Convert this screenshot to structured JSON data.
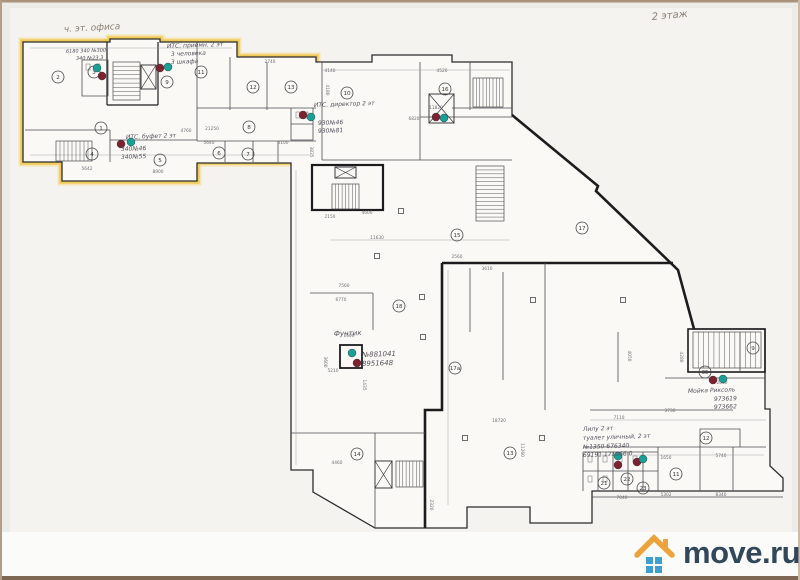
{
  "photo": {
    "type": "scanned floor plan photo",
    "floor_note_top_left": "ч. эт. офиса",
    "floor_note_top_right": "2 этаж"
  },
  "brand": {
    "name": "move.ru",
    "colors": {
      "roof": "#eda33c",
      "windows": "#3f9ed0",
      "text": "#33475b"
    }
  },
  "plan": {
    "highlight_color": "#f0c339",
    "marker_colors": {
      "teal": "#17a093",
      "red": "#7e2130"
    },
    "annotations": [
      {
        "text": "ч. эт. офиса",
        "x": 64,
        "y": 32,
        "size": 9,
        "rot": -3,
        "kind": "pencil"
      },
      {
        "text": "2 этаж",
        "x": 652,
        "y": 20,
        "size": 10,
        "rot": -5,
        "kind": "pencil"
      },
      {
        "text": "6180 340 №300",
        "x": 66,
        "y": 53,
        "size": 5
      },
      {
        "text": "340 №23.3",
        "x": 76,
        "y": 60,
        "size": 5
      },
      {
        "text": "ИТС. приёмн. 2 эт",
        "x": 167,
        "y": 48,
        "size": 6
      },
      {
        "text": "3 человека",
        "x": 171,
        "y": 56,
        "size": 6
      },
      {
        "text": "3 шкафа",
        "x": 171,
        "y": 64,
        "size": 6
      },
      {
        "text": "ИТС. директор 2 эт",
        "x": 314,
        "y": 107,
        "size": 6
      },
      {
        "text": "930№46",
        "x": 318,
        "y": 125,
        "size": 6
      },
      {
        "text": "930№81",
        "x": 318,
        "y": 133,
        "size": 6
      },
      {
        "text": "ИТС. буфет 2 эт",
        "x": 126,
        "y": 139,
        "size": 6
      },
      {
        "text": "340№46",
        "x": 121,
        "y": 151,
        "size": 6
      },
      {
        "text": "340№55",
        "x": 121,
        "y": 159,
        "size": 6
      },
      {
        "text": "Фунтик",
        "x": 334,
        "y": 336,
        "size": 7
      },
      {
        "text": "№881041",
        "x": 362,
        "y": 357,
        "size": 7
      },
      {
        "text": "8951648",
        "x": 362,
        "y": 366,
        "size": 7
      },
      {
        "text": "Мойка Риксоль",
        "x": 688,
        "y": 393,
        "size": 6
      },
      {
        "text": "973619",
        "x": 714,
        "y": 401,
        "size": 6
      },
      {
        "text": "973662",
        "x": 714,
        "y": 409,
        "size": 6
      },
      {
        "text": "Лилу 2 эт",
        "x": 583,
        "y": 431,
        "size": 6
      },
      {
        "text": "туалет уличный, 2 эт",
        "x": 583,
        "y": 440,
        "size": 6
      },
      {
        "text": "№1350  676340",
        "x": 583,
        "y": 449,
        "size": 6
      },
      {
        "text": "69191  171066 0",
        "x": 583,
        "y": 457,
        "size": 6
      }
    ],
    "rooms": [
      {
        "n": "2",
        "x": 58,
        "y": 77
      },
      {
        "n": "3",
        "x": 94,
        "y": 72
      },
      {
        "n": "9",
        "x": 167,
        "y": 82
      },
      {
        "n": "1",
        "x": 101,
        "y": 128
      },
      {
        "n": "11",
        "x": 201,
        "y": 72
      },
      {
        "n": "12",
        "x": 253,
        "y": 87
      },
      {
        "n": "13",
        "x": 291,
        "y": 87
      },
      {
        "n": "8",
        "x": 249,
        "y": 127
      },
      {
        "n": "4",
        "x": 92,
        "y": 154
      },
      {
        "n": "5",
        "x": 160,
        "y": 160
      },
      {
        "n": "6",
        "x": 219,
        "y": 153
      },
      {
        "n": "7",
        "x": 248,
        "y": 154
      },
      {
        "n": "10",
        "x": 347,
        "y": 93
      },
      {
        "n": "16",
        "x": 445,
        "y": 89
      },
      {
        "n": "15",
        "x": 457,
        "y": 235
      },
      {
        "n": "17",
        "x": 582,
        "y": 228
      },
      {
        "n": "18",
        "x": 399,
        "y": 306
      },
      {
        "n": "17а",
        "x": 455,
        "y": 368
      },
      {
        "n": "14",
        "x": 357,
        "y": 454
      },
      {
        "n": "13",
        "x": 510,
        "y": 453
      },
      {
        "n": "9",
        "x": 753,
        "y": 348
      },
      {
        "n": "35",
        "x": 705,
        "y": 372
      },
      {
        "n": "12",
        "x": 706,
        "y": 438
      },
      {
        "n": "11",
        "x": 676,
        "y": 474
      },
      {
        "n": "21",
        "x": 604,
        "y": 483
      },
      {
        "n": "22",
        "x": 627,
        "y": 479
      },
      {
        "n": "23",
        "x": 643,
        "y": 488
      }
    ],
    "dimensions": [
      {
        "t": "21250",
        "x": 212,
        "y": 130
      },
      {
        "t": "5640",
        "x": 209,
        "y": 144
      },
      {
        "t": "4100",
        "x": 283,
        "y": 144
      },
      {
        "t": "3835",
        "x": 310,
        "y": 152,
        "r": 90
      },
      {
        "t": "5642",
        "x": 87,
        "y": 170
      },
      {
        "t": "8900",
        "x": 158,
        "y": 173
      },
      {
        "t": "4760",
        "x": 186,
        "y": 132
      },
      {
        "t": "2740",
        "x": 270,
        "y": 63
      },
      {
        "t": "4140",
        "x": 330,
        "y": 72
      },
      {
        "t": "4520",
        "x": 442,
        "y": 72
      },
      {
        "t": "11820",
        "x": 436,
        "y": 109
      },
      {
        "t": "6820",
        "x": 414,
        "y": 120
      },
      {
        "t": "4180",
        "x": 326,
        "y": 90,
        "r": 90
      },
      {
        "t": "2150",
        "x": 330,
        "y": 218
      },
      {
        "t": "4600",
        "x": 367,
        "y": 214
      },
      {
        "t": "11630",
        "x": 377,
        "y": 239
      },
      {
        "t": "7560",
        "x": 344,
        "y": 287
      },
      {
        "t": "6770",
        "x": 341,
        "y": 301
      },
      {
        "t": "1600",
        "x": 349,
        "y": 337
      },
      {
        "t": "5210",
        "x": 333,
        "y": 372
      },
      {
        "t": "1435",
        "x": 363,
        "y": 385,
        "r": 90
      },
      {
        "t": "3600",
        "x": 324,
        "y": 362,
        "r": 90
      },
      {
        "t": "2560",
        "x": 457,
        "y": 258
      },
      {
        "t": "3610",
        "x": 487,
        "y": 270
      },
      {
        "t": "4050",
        "x": 628,
        "y": 356,
        "r": 90
      },
      {
        "t": "4280",
        "x": 680,
        "y": 357,
        "r": 90
      },
      {
        "t": "2000",
        "x": 722,
        "y": 384
      },
      {
        "t": "7110",
        "x": 619,
        "y": 419
      },
      {
        "t": "3730",
        "x": 670,
        "y": 412
      },
      {
        "t": "18720",
        "x": 499,
        "y": 422
      },
      {
        "t": "11260",
        "x": 521,
        "y": 450,
        "r": 90
      },
      {
        "t": "2320",
        "x": 430,
        "y": 505,
        "r": 90
      },
      {
        "t": "1650",
        "x": 666,
        "y": 459
      },
      {
        "t": "5740",
        "x": 721,
        "y": 457
      },
      {
        "t": "5302",
        "x": 666,
        "y": 496
      },
      {
        "t": "8340",
        "x": 721,
        "y": 496
      },
      {
        "t": "7040",
        "x": 622,
        "y": 499
      },
      {
        "t": "4460",
        "x": 337,
        "y": 464
      }
    ],
    "markers": [
      {
        "c": "teal",
        "x": 97,
        "y": 68
      },
      {
        "c": "red",
        "x": 102,
        "y": 76
      },
      {
        "c": "red",
        "x": 160,
        "y": 68
      },
      {
        "c": "teal",
        "x": 168,
        "y": 67
      },
      {
        "c": "red",
        "x": 303,
        "y": 115
      },
      {
        "c": "teal",
        "x": 311,
        "y": 117
      },
      {
        "c": "red",
        "x": 436,
        "y": 117
      },
      {
        "c": "teal",
        "x": 444,
        "y": 118
      },
      {
        "c": "red",
        "x": 121,
        "y": 144
      },
      {
        "c": "teal",
        "x": 131,
        "y": 142
      },
      {
        "c": "teal",
        "x": 352,
        "y": 353
      },
      {
        "c": "red",
        "x": 357,
        "y": 363
      },
      {
        "c": "red",
        "x": 713,
        "y": 380
      },
      {
        "c": "teal",
        "x": 723,
        "y": 379
      },
      {
        "c": "teal",
        "x": 618,
        "y": 456
      },
      {
        "c": "red",
        "x": 618,
        "y": 465
      },
      {
        "c": "red",
        "x": 637,
        "y": 462
      },
      {
        "c": "teal",
        "x": 643,
        "y": 459
      }
    ]
  }
}
